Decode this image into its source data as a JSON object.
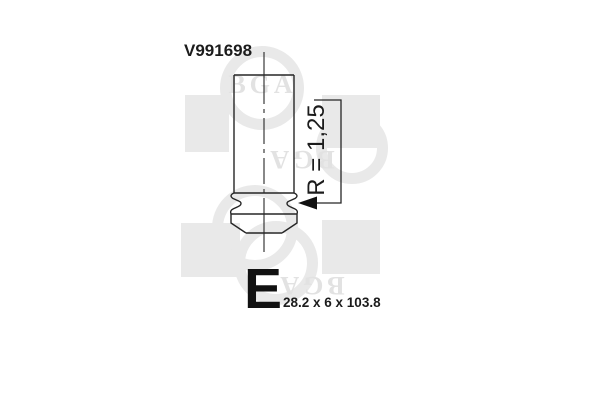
{
  "page": {
    "background": "#ffffff"
  },
  "part": {
    "number": "V991698",
    "category_letter": "E",
    "size_text": "28.2 x 6 x 103.8",
    "radius_label": "R = 1,25"
  },
  "watermark": {
    "brand": "BGA",
    "color": "#e9e9e9"
  },
  "drawing": {
    "line_color": "#262626",
    "subject": "engine-valve-side-view"
  }
}
